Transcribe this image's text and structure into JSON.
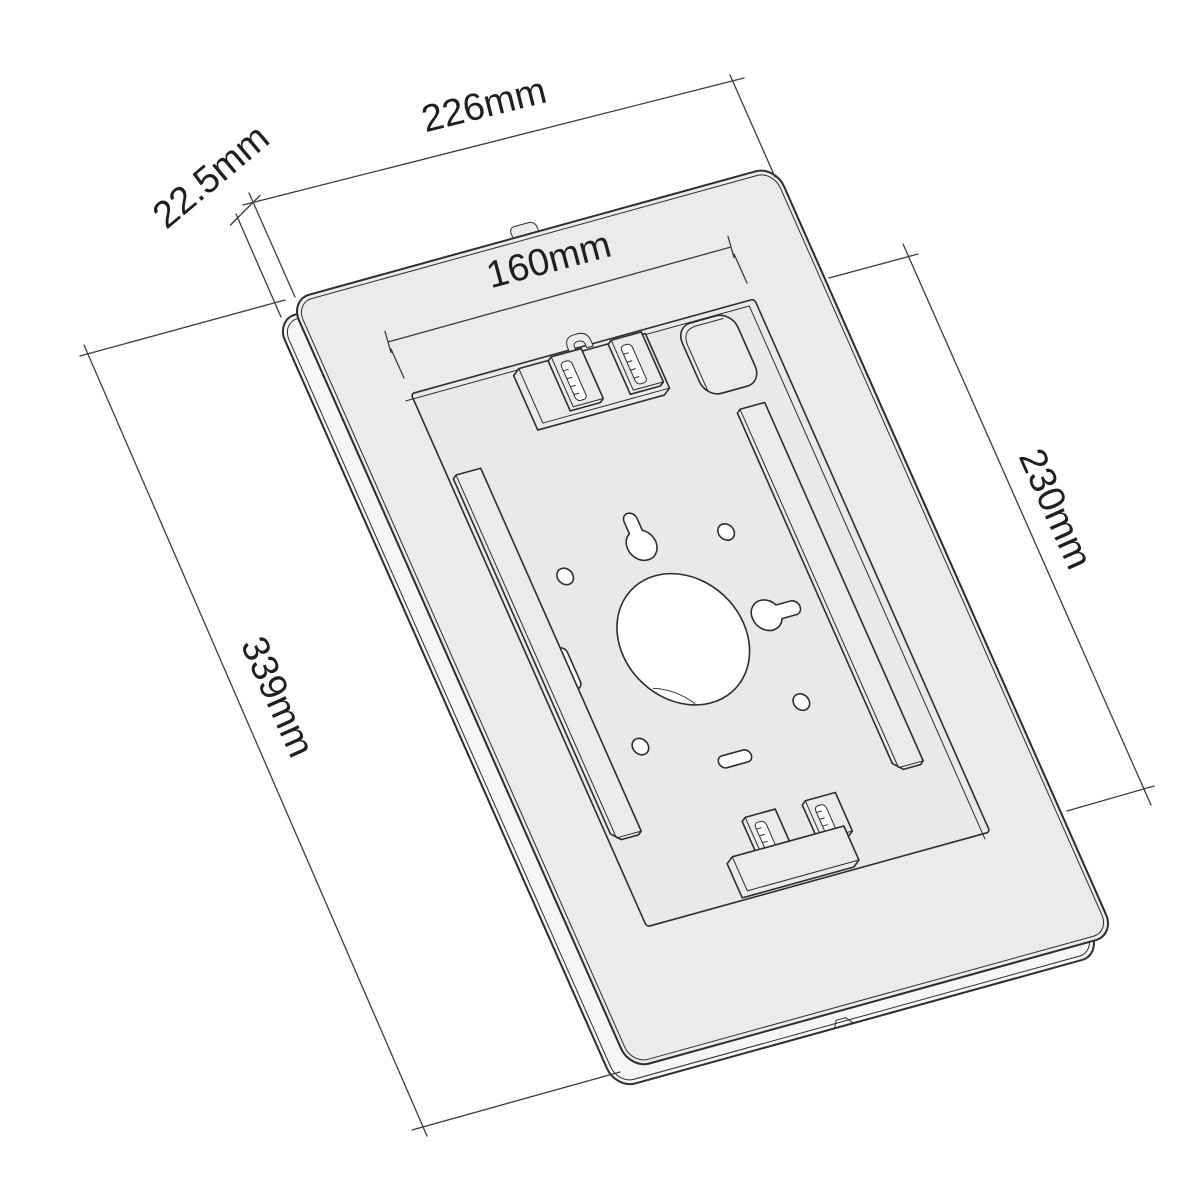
{
  "drawing": {
    "type": "technical-dimension-drawing",
    "subject": "Tablet wall-mount enclosure, rear perspective view",
    "units": "mm"
  },
  "dimensions": {
    "outer_width": {
      "label": "226mm",
      "value": 226
    },
    "case_depth": {
      "label": "22.5mm",
      "value": 22.5
    },
    "inner_width": {
      "label": "160mm",
      "value": 160
    },
    "inner_height": {
      "label": "230mm",
      "value": 230
    },
    "outer_height": {
      "label": "339mm",
      "value": 339
    }
  },
  "colors": {
    "background": "#ffffff",
    "line": "#2d2d2d",
    "dimension_line": "#3c3c3c",
    "text": "#1f1f1f",
    "face_fill": "#ebebeb",
    "back_fill": "#f6f6f6",
    "recess_fill": "#e9e9e9",
    "hole_fill": "#ffffff"
  }
}
